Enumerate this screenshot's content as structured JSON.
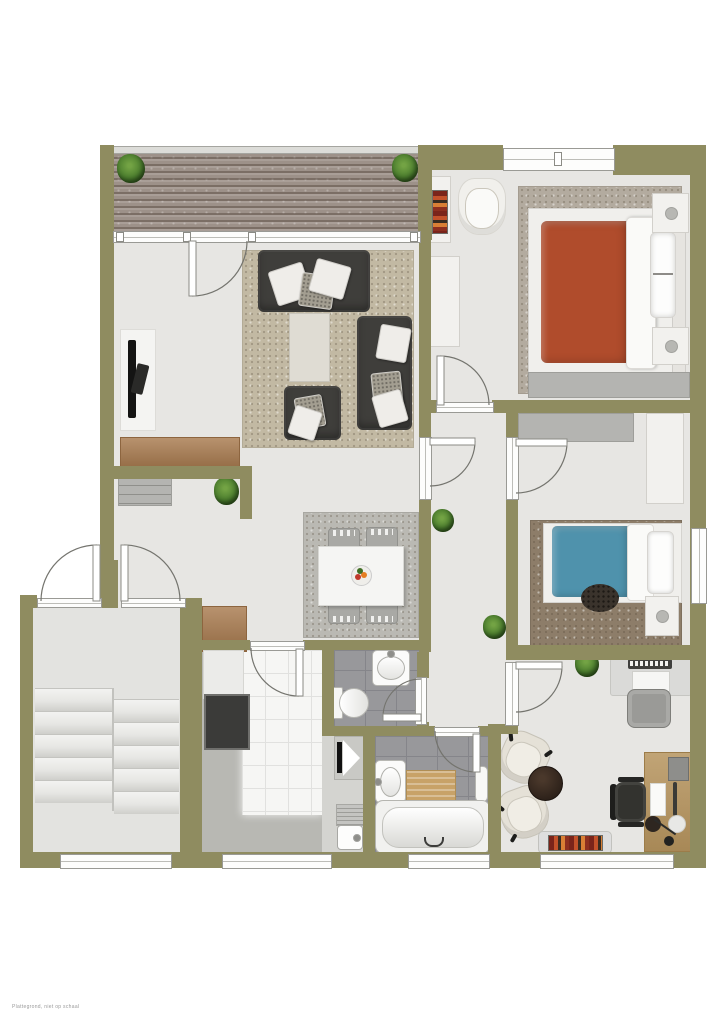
{
  "watermark": "Plattegrond, niet op schaal",
  "colors": {
    "wall": "#8f8c60",
    "floor": "#e7e6e3",
    "deck": "#9d9189",
    "living_rug": "#c2b9a3",
    "sofa_dark": "#3f3e3b",
    "pillow_light": "#efede9",
    "wood_cabinet": "#a87a4e",
    "dining_rug": "#bab9b3",
    "table_white": "#f5f5f3",
    "chair_gray": "#a9a9a5",
    "wet_tile": "#98989b",
    "wet_tile_line": "#85858a",
    "kitchen_floor": "#b8b8b3",
    "kitchen_tile": "#f6f6f4",
    "appliance_dark": "#3b3b39",
    "bed1_duvet": "#b04c2c",
    "bed2_duvet": "#4f92ac",
    "bed1_rug": "#b3ab9f",
    "bed2_rug": "#8d7d69",
    "plant_green": "#4a7c2d",
    "desk_wood": "#b6945e",
    "bath_mat": "#c8a268",
    "door_arc": "#74746e",
    "frame_gray": "#9a9a95"
  }
}
